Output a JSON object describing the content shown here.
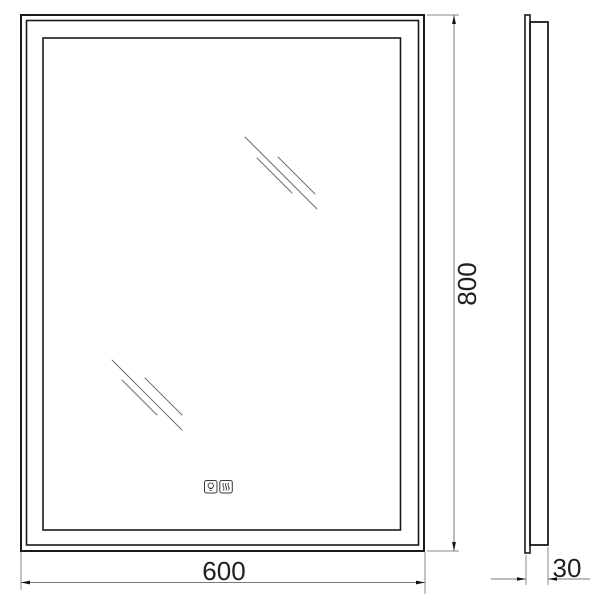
{
  "drawing": {
    "type": "dimensioned technical drawing",
    "colors": {
      "background": "#ffffff",
      "outline": "#1a1a1a",
      "dimension_line": "#7a7a7a",
      "arrow": "#111111",
      "text": "#1f1f1f",
      "glint": "#6f6f6f",
      "icon": "#3a3a3a"
    },
    "dimensions": {
      "width": {
        "label": "600"
      },
      "height": {
        "label": "800"
      },
      "depth": {
        "label": "30"
      }
    },
    "icons": [
      {
        "name": "light-bulb-icon"
      },
      {
        "name": "anti-fog-waves-icon"
      }
    ]
  }
}
